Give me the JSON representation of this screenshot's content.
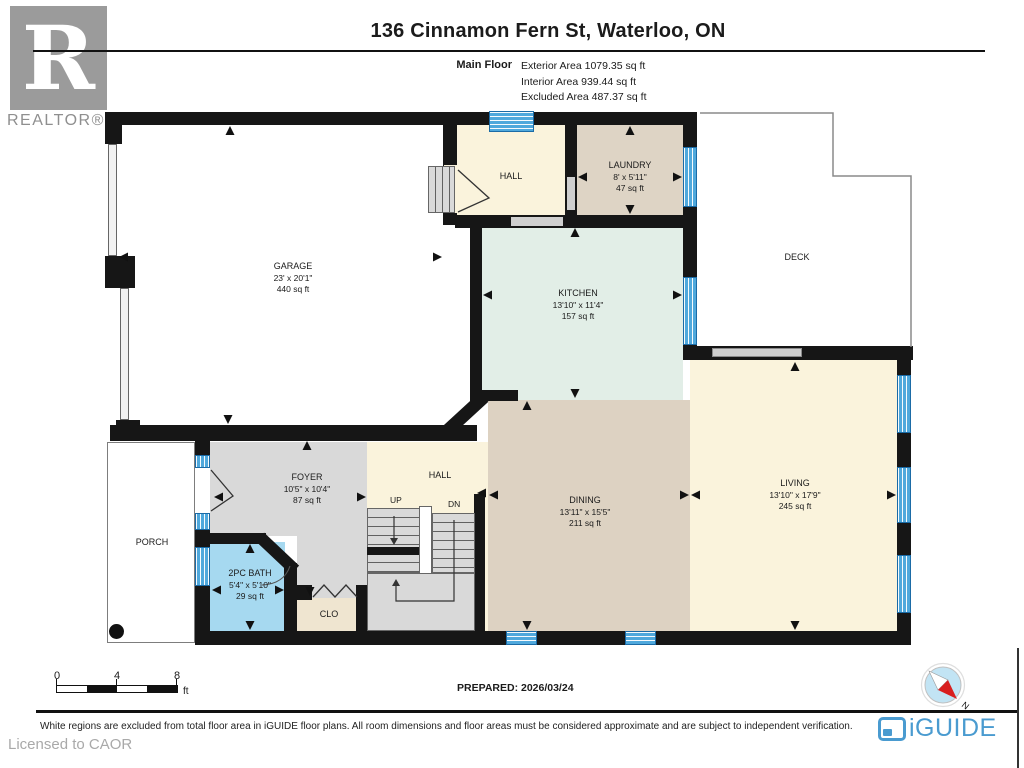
{
  "header": {
    "brand": {
      "logo_letter": "R",
      "logo_word": "REALTOR®"
    },
    "title": "136 Cinnamon Fern St, Waterloo, ON",
    "floor_label": "Main Floor",
    "areas": {
      "exterior": "Exterior Area 1079.35 sq ft",
      "interior": "Interior Area 939.44 sq ft",
      "excluded": "Excluded Area 487.37 sq ft"
    }
  },
  "plan": {
    "rooms": {
      "garage": {
        "name": "GARAGE",
        "dims": "23' x 20'1\"",
        "area": "440 sq ft"
      },
      "hall_top": {
        "name": "HALL"
      },
      "laundry": {
        "name": "LAUNDRY",
        "dims": "8' x 5'11\"",
        "area": "47 sq ft"
      },
      "kitchen": {
        "name": "KITCHEN",
        "dims": "13'10\" x 11'4\"",
        "area": "157 sq ft"
      },
      "deck": {
        "name": "DECK"
      },
      "living": {
        "name": "LIVING",
        "dims": "13'10\" x 17'9\"",
        "area": "245 sq ft"
      },
      "dining": {
        "name": "DINING",
        "dims": "13'11\" x 15'5\"",
        "area": "211 sq ft"
      },
      "foyer": {
        "name": "FOYER",
        "dims": "10'5\" x 10'4\"",
        "area": "87 sq ft"
      },
      "hall_mid": {
        "name": "HALL"
      },
      "bath": {
        "name": "2PC BATH",
        "dims": "5'4\" x 5'10\"",
        "area": "29 sq ft"
      },
      "closet": {
        "name": "CLO"
      },
      "porch": {
        "name": "PORCH"
      },
      "stairs": {
        "up": "UP",
        "down": "DN"
      }
    }
  },
  "footer_bar": {
    "scale": {
      "t0": "0",
      "t4": "4",
      "t8": "8",
      "unit": "ft"
    },
    "prepared": "PREPARED: 2026/03/24",
    "compass_n": "N"
  },
  "footer": {
    "disclaimer": "White regions are excluded from total floor area in iGUIDE floor plans. All room dimensions and floor areas must be considered approximate and are subject to independent verification.",
    "licensed": "Licensed to CAOR",
    "brand": "iGUIDE"
  }
}
